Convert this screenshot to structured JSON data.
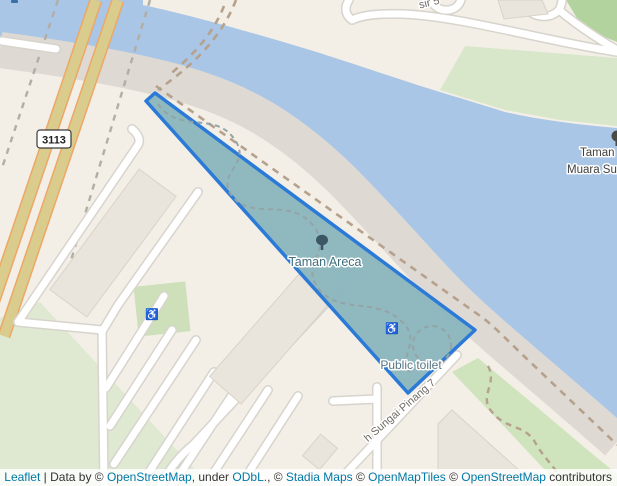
{
  "map": {
    "park_label": "Taman Areca",
    "toilet_label": "Public toilet",
    "right_label_line1": "Taman",
    "right_label_line2": "Muara Sun",
    "street_label": "h Sungai Pinang 7",
    "top_street_fragment": "sir 5",
    "road_shield": "3113"
  },
  "icons": {
    "park_tree": "tree-icon",
    "park_wheelchair": "wheelchair-icon",
    "playground_wheelchair": "wheelchair-icon",
    "right_edge_tree": "tree-icon-clipped"
  },
  "colors": {
    "land": "#f3efe7",
    "water": "#a9c6e6",
    "park_fill": "#8ab6bd",
    "park_border": "#2b7ad8",
    "highway_fill": "#d9cc8c",
    "highway_casing": "#eda766",
    "green_light": "#dfe9d1",
    "green_bright": "#b2d39e",
    "building": "#e9e4dc",
    "link": "#0078a8"
  },
  "attribution": {
    "parts": [
      {
        "text": "Leaflet"
      },
      {
        "text": " | Data by © "
      },
      {
        "text": "OpenStreetMap"
      },
      {
        "text": ", under "
      },
      {
        "text": "ODbL."
      },
      {
        "text": ", © "
      },
      {
        "text": "Stadia Maps"
      },
      {
        "text": " © "
      },
      {
        "text": "OpenMapTiles"
      },
      {
        "text": " © "
      },
      {
        "text": "OpenStreetMap"
      },
      {
        "text": " contributors"
      }
    ]
  }
}
